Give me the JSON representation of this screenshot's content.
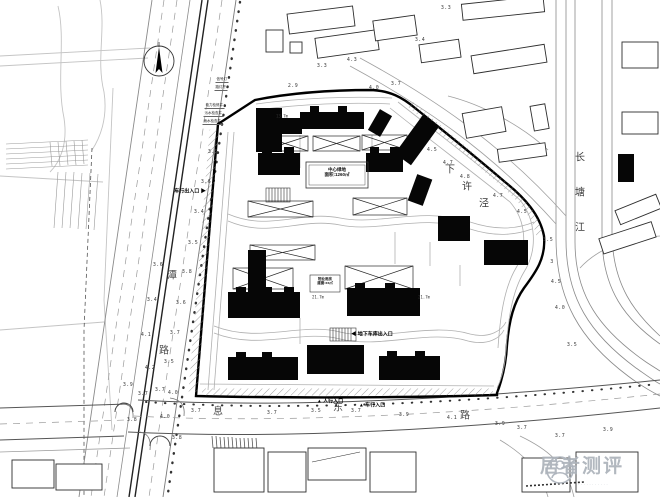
{
  "watermark": {
    "text": "居者测评",
    "dots": "···········",
    "color": "#adb3bb"
  },
  "center_box": {
    "line1": "中心绿地",
    "line2": "面积:1260㎡"
  },
  "box2": {
    "line1": "物业用房",
    "line2": "建面:xx㎡"
  },
  "labels": {
    "river": [
      {
        "t": "长",
        "x": 580,
        "y": 156
      },
      {
        "t": "塘",
        "x": 580,
        "y": 191
      },
      {
        "t": "江",
        "x": 580,
        "y": 226
      }
    ],
    "creek": [
      {
        "t": "下",
        "x": 450,
        "y": 168
      },
      {
        "t": "许",
        "x": 467,
        "y": 185
      },
      {
        "t": "泾",
        "x": 484,
        "y": 202
      }
    ],
    "west_road": [
      {
        "t": "潭",
        "x": 172,
        "y": 274
      },
      {
        "t": "路",
        "x": 164,
        "y": 349
      }
    ],
    "bottom_road": [
      {
        "t": "息",
        "x": 218,
        "y": 410
      },
      {
        "t": "东",
        "x": 338,
        "y": 406
      },
      {
        "t": "路",
        "x": 465,
        "y": 414
      }
    ]
  },
  "entrances": [
    {
      "t": "车行出入口",
      "post": "▶",
      "x": 190,
      "y": 191
    },
    {
      "t": "人行入口",
      "pre": "▲",
      "x": 330,
      "y": 401
    },
    {
      "t": "车行入口",
      "pre": "▲",
      "x": 372,
      "y": 405
    },
    {
      "t": "地下车库出入口",
      "pre": "◀",
      "x": 372,
      "y": 334
    }
  ],
  "utility_labels": [
    {
      "t": "信号灯",
      "x": 228,
      "y": 80
    },
    {
      "t": "路灯杆",
      "x": 227,
      "y": 88
    },
    {
      "t": "电力检修井",
      "x": 224,
      "y": 106
    },
    {
      "t": "污水检查井",
      "x": 223,
      "y": 114
    },
    {
      "t": "雨水检查井",
      "x": 222,
      "y": 122
    }
  ],
  "dim_labels": [
    {
      "t": "13.7m",
      "x": 282,
      "y": 116
    },
    {
      "t": "21.7m",
      "x": 318,
      "y": 297
    },
    {
      "t": "21.7m",
      "x": 424,
      "y": 297
    }
  ],
  "spot_elevations": [
    {
      "v": "3.5",
      "x": 213,
      "y": 152
    },
    {
      "v": "3.6",
      "x": 206,
      "y": 182
    },
    {
      "v": "3.4",
      "x": 199,
      "y": 212
    },
    {
      "v": "3.5",
      "x": 193,
      "y": 243
    },
    {
      "v": "3.8",
      "x": 187,
      "y": 272
    },
    {
      "v": "3.6",
      "x": 181,
      "y": 303
    },
    {
      "v": "3.7",
      "x": 175,
      "y": 333
    },
    {
      "v": "3.5",
      "x": 169,
      "y": 362
    },
    {
      "v": "3.7",
      "x": 160,
      "y": 390
    },
    {
      "v": "3.4",
      "x": 152,
      "y": 300
    },
    {
      "v": "3.6",
      "x": 158,
      "y": 265
    },
    {
      "v": "4.1",
      "x": 146,
      "y": 335
    },
    {
      "v": "4.2",
      "x": 150,
      "y": 368
    },
    {
      "v": "3.9",
      "x": 128,
      "y": 385
    },
    {
      "v": "2.9",
      "x": 293,
      "y": 86
    },
    {
      "v": "3.3",
      "x": 322,
      "y": 66
    },
    {
      "v": "4.3",
      "x": 352,
      "y": 60
    },
    {
      "v": "4.0",
      "x": 374,
      "y": 88
    },
    {
      "v": "3.7",
      "x": 396,
      "y": 84
    },
    {
      "v": "3.3",
      "x": 446,
      "y": 8
    },
    {
      "v": "3.4",
      "x": 420,
      "y": 40
    },
    {
      "v": "4.5",
      "x": 432,
      "y": 150
    },
    {
      "v": "4.7",
      "x": 448,
      "y": 163
    },
    {
      "v": "4.8",
      "x": 465,
      "y": 177
    },
    {
      "v": "4.7",
      "x": 498,
      "y": 196
    },
    {
      "v": "4.5",
      "x": 522,
      "y": 212
    },
    {
      "v": "3.5",
      "x": 548,
      "y": 240
    },
    {
      "v": "3",
      "x": 552,
      "y": 262
    },
    {
      "v": "4.5",
      "x": 556,
      "y": 282
    },
    {
      "v": "4.0",
      "x": 560,
      "y": 308
    },
    {
      "v": "3.5",
      "x": 572,
      "y": 345
    },
    {
      "v": "3.8",
      "x": 132,
      "y": 420
    },
    {
      "v": "4.0",
      "x": 165,
      "y": 417
    },
    {
      "v": "3.7",
      "x": 143,
      "y": 394
    },
    {
      "v": "4.0",
      "x": 173,
      "y": 393
    },
    {
      "v": "3.7",
      "x": 196,
      "y": 411
    },
    {
      "v": "3.7",
      "x": 272,
      "y": 413
    },
    {
      "v": "3.5",
      "x": 316,
      "y": 411
    },
    {
      "v": "3.7",
      "x": 356,
      "y": 411
    },
    {
      "v": "3.9",
      "x": 404,
      "y": 415
    },
    {
      "v": "4.1",
      "x": 452,
      "y": 418
    },
    {
      "v": "3.9",
      "x": 500,
      "y": 424
    },
    {
      "v": "3.7",
      "x": 522,
      "y": 428
    },
    {
      "v": "3.7",
      "x": 560,
      "y": 436
    },
    {
      "v": "3.9",
      "x": 608,
      "y": 430
    },
    {
      "v": "3.8",
      "x": 177,
      "y": 438
    }
  ]
}
